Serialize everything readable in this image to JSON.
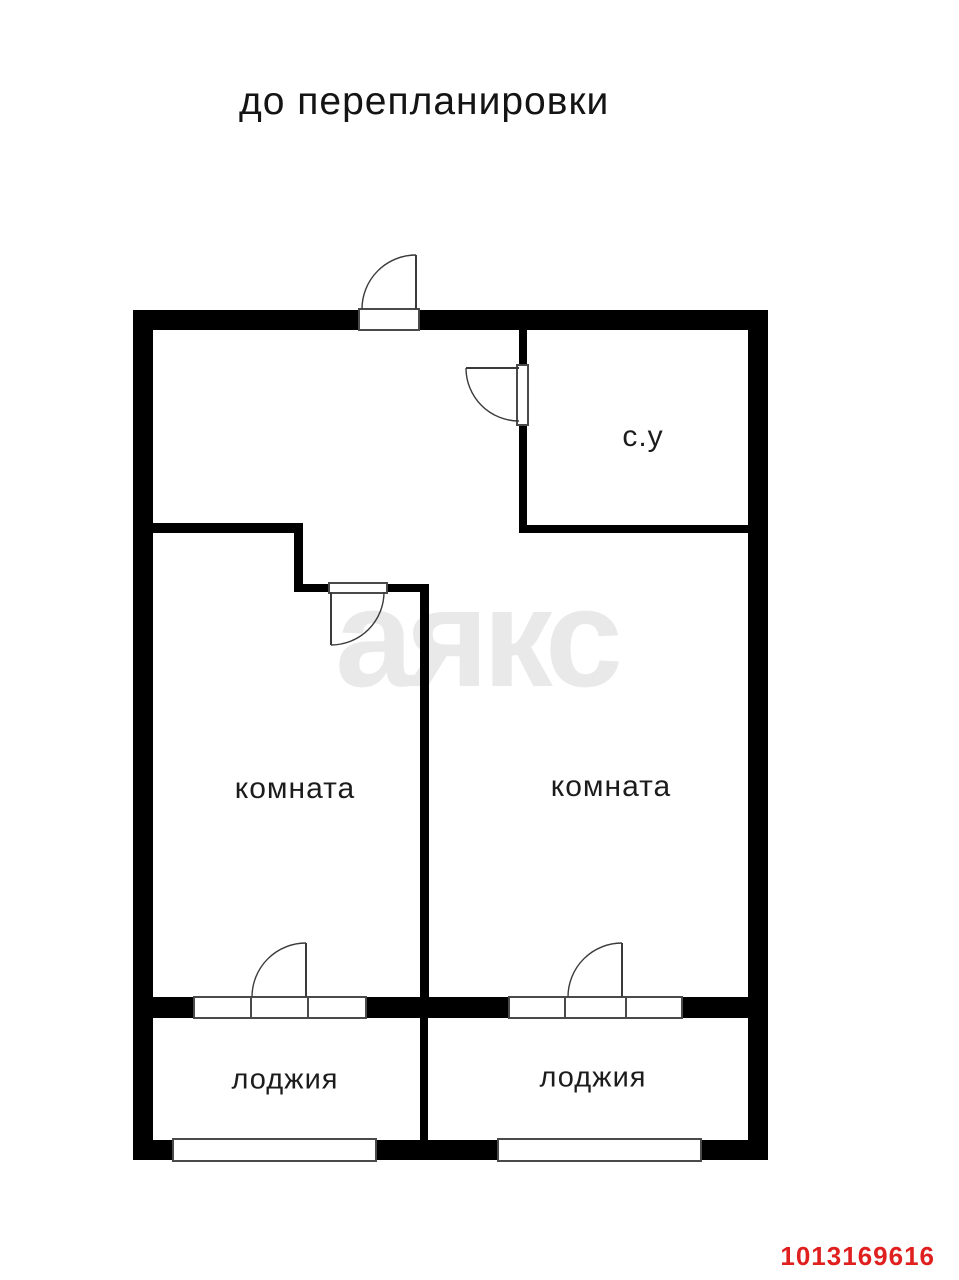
{
  "page": {
    "title": "до перепланировки",
    "watermark": "аякс",
    "listing_id": "1013169616"
  },
  "floor_plan": {
    "stage": "before renovation",
    "rooms": [
      {
        "key": "bathroom",
        "label": "с.у"
      },
      {
        "key": "room-left",
        "label": "комната"
      },
      {
        "key": "room-right",
        "label": "комната"
      },
      {
        "key": "loggia-left",
        "label": "лоджия"
      },
      {
        "key": "loggia-right",
        "label": "лоджия"
      }
    ],
    "features": [
      "entrance-door",
      "bathroom-door",
      "room-left-door",
      "balcony-door-left",
      "balcony-door-right",
      "window-loggia-left",
      "window-loggia-right",
      "window-bottom-left",
      "window-bottom-right"
    ]
  },
  "colors": {
    "wall": "#000000",
    "door_line": "#3a3a3a",
    "watermark": "#e9e9e9",
    "id_text": "#e01f1f",
    "text": "#1c1c1c"
  }
}
